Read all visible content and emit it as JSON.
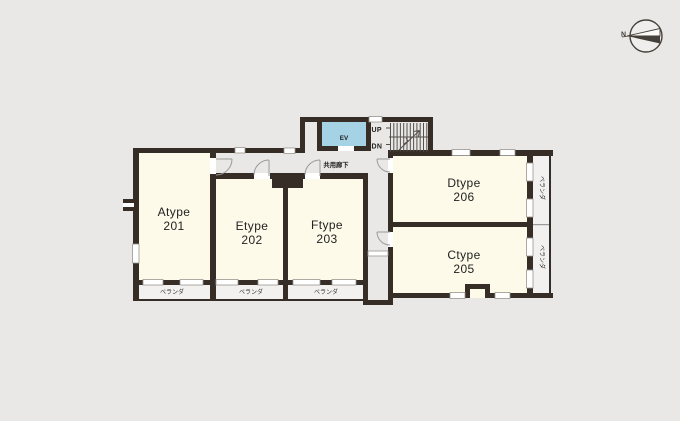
{
  "compass": {
    "north_label": "N"
  },
  "corridor": {
    "label": "共用廊下"
  },
  "elevator": {
    "label": "EV"
  },
  "stairs": {
    "up_label": "UP",
    "down_label": "DN"
  },
  "veranda": {
    "label": "ベランダ"
  },
  "rooms": [
    {
      "type": "Atype",
      "number": "201"
    },
    {
      "type": "Etype",
      "number": "202"
    },
    {
      "type": "Ftype",
      "number": "203"
    },
    {
      "type": "Dtype",
      "number": "206"
    },
    {
      "type": "Ctype",
      "number": "205"
    }
  ],
  "colors": {
    "bg": "#E9E8E6",
    "wall": "#362D26",
    "room": "#FDFAE9",
    "elevator": "#A5D2E4",
    "veranda": "#F2F1EF",
    "line": "#9A9A9A",
    "text": "#222222"
  }
}
